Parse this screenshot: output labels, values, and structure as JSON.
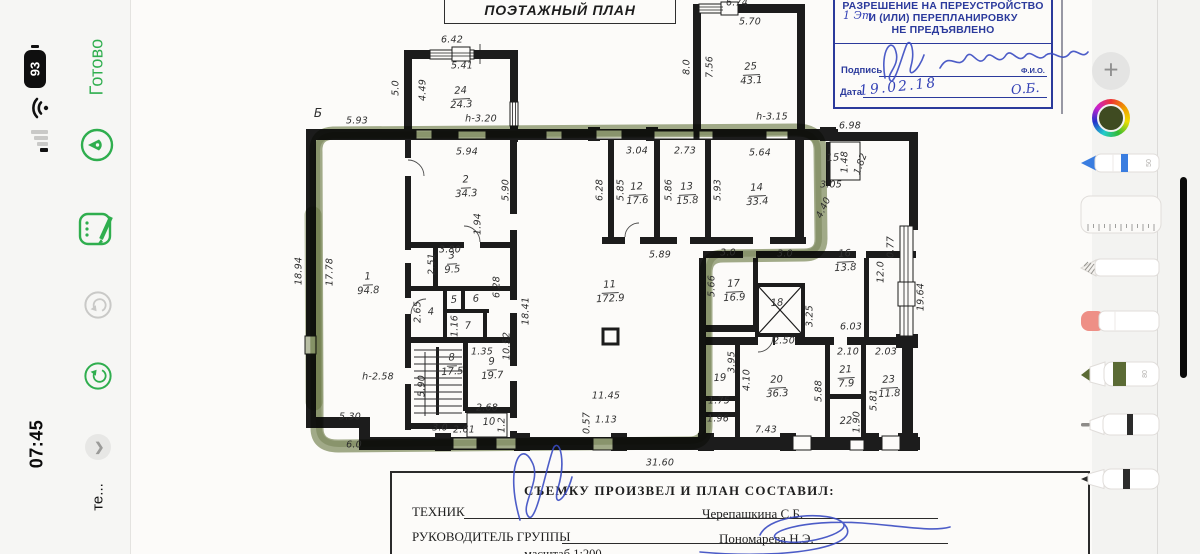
{
  "status_bar": {
    "time": "07:45",
    "battery_percent": "93",
    "app_label": "те..."
  },
  "nav": {
    "done_label": "Готово"
  },
  "toolbar": {
    "pen_width_label": "50",
    "marker_width_label": "80"
  },
  "colors": {
    "accent_green": "#2fae4e",
    "stamp_blue": "#2b3a9c",
    "ink_blue": "#3a4bc2",
    "highlighter_olive": "#65763d",
    "selected_color": "#3f4b21"
  },
  "plan": {
    "title": "ПОЭТАЖНЫЙ ПЛАН",
    "axis_letter": "Б",
    "stamp": {
      "line1": "РАЗРЕШЕНИЕ НА ПЕРЕУСТРОЙСТВО",
      "line2": "И (ИЛИ) ПЕРЕПЛАНИРОВКУ",
      "line3": "НЕ ПРЕДЪЯВЛЕНО",
      "handwritten_note": "1 Эт",
      "sign_label": "Подпись",
      "fio_label": "Ф.И.О.",
      "date_label": "Дата",
      "date_value": "19.02.18",
      "initials": "О.Б."
    },
    "footer": {
      "title": "СЪЕМКУ ПРОИЗВЕЛ И ПЛАН СОСТАВИЛ:",
      "technician_label": "ТЕХНИК",
      "technician_name": "Черепашкина С.Б.",
      "lead_label": "РУКОВОДИТЕЛЬ ГРУППЫ",
      "lead_name": "Пономарева Н.Э.",
      "scale": "масштаб 1:200"
    },
    "rooms": [
      {
        "n": "1",
        "a": "94.8",
        "x": 368,
        "y": 284
      },
      {
        "n": "2",
        "a": "34.3",
        "x": 466,
        "y": 187
      },
      {
        "n": "3",
        "a": "9.5",
        "x": 452,
        "y": 263
      },
      {
        "n": "4",
        "a": "",
        "x": 431,
        "y": 313
      },
      {
        "n": "5",
        "a": "",
        "x": 454,
        "y": 301
      },
      {
        "n": "6",
        "a": "",
        "x": 476,
        "y": 300
      },
      {
        "n": "7",
        "a": "",
        "x": 468,
        "y": 327
      },
      {
        "n": "8",
        "a": "17.5",
        "x": 452,
        "y": 365
      },
      {
        "n": "9",
        "a": "19.7",
        "x": 492,
        "y": 369
      },
      {
        "n": "10",
        "a": "",
        "x": 489,
        "y": 423
      },
      {
        "n": "11",
        "a": "172.9",
        "x": 610,
        "y": 292
      },
      {
        "n": "12",
        "a": "17.6",
        "x": 637,
        "y": 194
      },
      {
        "n": "13",
        "a": "15.8",
        "x": 687,
        "y": 194
      },
      {
        "n": "14",
        "a": "33.4",
        "x": 757,
        "y": 195
      },
      {
        "n": "15",
        "a": "",
        "x": 833,
        "y": 159
      },
      {
        "n": "16",
        "a": "13.8",
        "x": 845,
        "y": 261
      },
      {
        "n": "17",
        "a": "16.9",
        "x": 734,
        "y": 291
      },
      {
        "n": "18",
        "a": "",
        "x": 777,
        "y": 304
      },
      {
        "n": "19",
        "a": "",
        "x": 720,
        "y": 379
      },
      {
        "n": "20",
        "a": "36.3",
        "x": 777,
        "y": 387
      },
      {
        "n": "21",
        "a": "7.9",
        "x": 846,
        "y": 377
      },
      {
        "n": "22",
        "a": "",
        "x": 846,
        "y": 422
      },
      {
        "n": "23",
        "a": "11.8",
        "x": 889,
        "y": 387
      },
      {
        "n": "24",
        "a": "24.3",
        "x": 461,
        "y": 98
      },
      {
        "n": "25",
        "a": "43.1",
        "x": 751,
        "y": 74
      }
    ],
    "dims": [
      {
        "t": "6.42",
        "x": 452,
        "y": 40,
        "r": 0
      },
      {
        "t": "5.41",
        "x": 462,
        "y": 66,
        "r": 0
      },
      {
        "t": "5.0",
        "x": 396,
        "y": 88,
        "r": -90
      },
      {
        "t": "4.49",
        "x": 423,
        "y": 90,
        "r": -90
      },
      {
        "t": "h-3.20",
        "x": 481,
        "y": 119,
        "r": 0
      },
      {
        "t": "5.93",
        "x": 357,
        "y": 121,
        "r": 0
      },
      {
        "t": "6.74",
        "x": 737,
        "y": 3,
        "r": 0
      },
      {
        "t": "5.70",
        "x": 750,
        "y": 22,
        "r": 0
      },
      {
        "t": "8.0",
        "x": 687,
        "y": 67,
        "r": -90
      },
      {
        "t": "7.56",
        "x": 710,
        "y": 67,
        "r": -90
      },
      {
        "t": "h-3.15",
        "x": 772,
        "y": 117,
        "r": 0
      },
      {
        "t": "6.98",
        "x": 850,
        "y": 126,
        "r": 0
      },
      {
        "t": "1.48",
        "x": 845,
        "y": 162,
        "r": -90
      },
      {
        "t": "1.82",
        "x": 861,
        "y": 164,
        "r": -70
      },
      {
        "t": "3.05",
        "x": 831,
        "y": 185,
        "r": 0
      },
      {
        "t": "5.94",
        "x": 467,
        "y": 152,
        "r": 0
      },
      {
        "t": "3.04",
        "x": 637,
        "y": 151,
        "r": 0
      },
      {
        "t": "2.73",
        "x": 685,
        "y": 151,
        "r": 0
      },
      {
        "t": "5.64",
        "x": 760,
        "y": 153,
        "r": 0
      },
      {
        "t": "5.90",
        "x": 506,
        "y": 190,
        "r": -90
      },
      {
        "t": "6.28",
        "x": 600,
        "y": 190,
        "r": -90
      },
      {
        "t": "5.85",
        "x": 621,
        "y": 190,
        "r": -90
      },
      {
        "t": "5.86",
        "x": 669,
        "y": 190,
        "r": -90
      },
      {
        "t": "5.93",
        "x": 718,
        "y": 190,
        "r": -90
      },
      {
        "t": "4.40",
        "x": 824,
        "y": 208,
        "r": -65
      },
      {
        "t": "0.77",
        "x": 891,
        "y": 247,
        "r": -90
      },
      {
        "t": "12.0",
        "x": 881,
        "y": 272,
        "r": -90
      },
      {
        "t": "19.64",
        "x": 921,
        "y": 297,
        "r": -90
      },
      {
        "t": "1.94",
        "x": 478,
        "y": 224,
        "r": -90
      },
      {
        "t": "3.80",
        "x": 450,
        "y": 250,
        "r": 0
      },
      {
        "t": "2.51",
        "x": 432,
        "y": 264,
        "r": -90
      },
      {
        "t": "18.94",
        "x": 299,
        "y": 271,
        "r": -90
      },
      {
        "t": "17.78",
        "x": 330,
        "y": 272,
        "r": -90
      },
      {
        "t": "5.89",
        "x": 660,
        "y": 255,
        "r": 0
      },
      {
        "t": "3.0",
        "x": 728,
        "y": 253,
        "r": 0
      },
      {
        "t": "3.0",
        "x": 785,
        "y": 254,
        "r": 0
      },
      {
        "t": "2.65",
        "x": 418,
        "y": 312,
        "r": -90
      },
      {
        "t": "6.28",
        "x": 497,
        "y": 287,
        "r": -90
      },
      {
        "t": "18.41",
        "x": 526,
        "y": 311,
        "r": -90
      },
      {
        "t": "1.16",
        "x": 455,
        "y": 326,
        "r": -90
      },
      {
        "t": "10.52",
        "x": 507,
        "y": 346,
        "r": -90
      },
      {
        "t": "1.35",
        "x": 482,
        "y": 352,
        "r": 0
      },
      {
        "t": "5.66",
        "x": 712,
        "y": 286,
        "r": -90
      },
      {
        "t": "3.25",
        "x": 810,
        "y": 316,
        "r": -90
      },
      {
        "t": "6.03",
        "x": 851,
        "y": 327,
        "r": 0
      },
      {
        "t": "2.50",
        "x": 784,
        "y": 341,
        "r": 0
      },
      {
        "t": "h-2.58",
        "x": 378,
        "y": 377,
        "r": 0
      },
      {
        "t": "5.90",
        "x": 422,
        "y": 386,
        "r": -90
      },
      {
        "t": "11.45",
        "x": 606,
        "y": 396,
        "r": 0
      },
      {
        "t": "2.68",
        "x": 487,
        "y": 408,
        "r": 0
      },
      {
        "t": "2.61",
        "x": 464,
        "y": 430,
        "r": 0
      },
      {
        "t": "1.2",
        "x": 502,
        "y": 425,
        "r": -90
      },
      {
        "t": "0.57",
        "x": 587,
        "y": 423,
        "r": -90
      },
      {
        "t": "1.13",
        "x": 606,
        "y": 420,
        "r": 0
      },
      {
        "t": "3.0",
        "x": 440,
        "y": 428,
        "r": 0
      },
      {
        "t": "5.30",
        "x": 350,
        "y": 417,
        "r": 0
      },
      {
        "t": "6.0",
        "x": 354,
        "y": 445,
        "r": 0
      },
      {
        "t": "3.95",
        "x": 732,
        "y": 362,
        "r": -90
      },
      {
        "t": "4.10",
        "x": 747,
        "y": 380,
        "r": -90
      },
      {
        "t": "1.75",
        "x": 719,
        "y": 401,
        "r": 0
      },
      {
        "t": "1.96",
        "x": 718,
        "y": 419,
        "r": 0
      },
      {
        "t": "2.10",
        "x": 848,
        "y": 352,
        "r": 0
      },
      {
        "t": "2.03",
        "x": 886,
        "y": 352,
        "r": 0
      },
      {
        "t": "5.88",
        "x": 819,
        "y": 391,
        "r": -90
      },
      {
        "t": "1.90",
        "x": 857,
        "y": 422,
        "r": -90
      },
      {
        "t": "5.81",
        "x": 874,
        "y": 400,
        "r": -90
      },
      {
        "t": "7.43",
        "x": 766,
        "y": 430,
        "r": 0
      },
      {
        "t": "31.60",
        "x": 660,
        "y": 463,
        "r": 0
      }
    ]
  }
}
